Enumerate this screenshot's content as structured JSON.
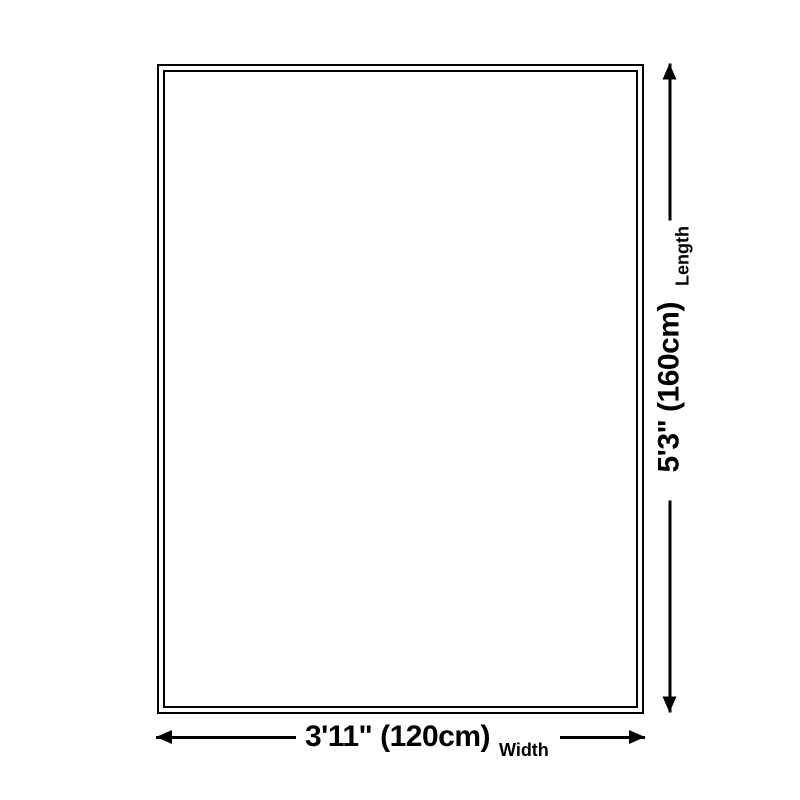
{
  "diagram": {
    "type": "product-size-diagram",
    "background_color": "#ffffff",
    "line_color": "#000000",
    "rug": {
      "shape": "rectangle",
      "border_style": "double"
    },
    "width": {
      "value": "3'11\" (120cm)",
      "label": "Width"
    },
    "length": {
      "value": "5'3\" (160cm)",
      "label": "Length"
    }
  }
}
